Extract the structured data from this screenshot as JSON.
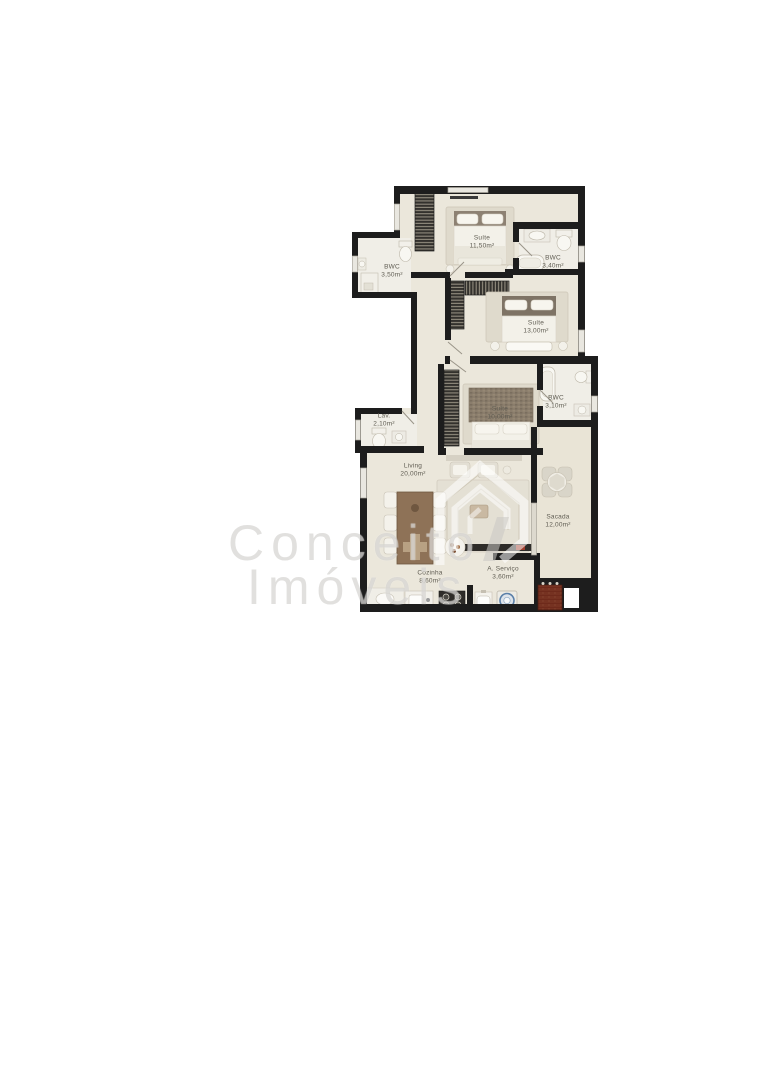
{
  "watermark": {
    "line1": "Conceito",
    "line2": "Imóveis"
  },
  "rooms": {
    "suite_1150": {
      "name": "Suíte",
      "area": "11,50m²"
    },
    "bwc_350": {
      "name": "BWC",
      "area": "3,50m²"
    },
    "bwc_340": {
      "name": "BWC",
      "area": "3,40m²"
    },
    "suite_1300": {
      "name": "Suíte",
      "area": "13,00m²"
    },
    "bwc_310": {
      "name": "BWC",
      "area": "3,10m²"
    },
    "suite_1000": {
      "name": "Suíte",
      "area": "10,00m²"
    },
    "lav": {
      "name": "Lav.",
      "area": "2,10m²"
    },
    "living": {
      "name": "Living",
      "area": "20,00m²"
    },
    "sacada": {
      "name": "Sacada",
      "area": "12,00m²"
    },
    "cozinha": {
      "name": "Cozinha",
      "area": "8,60m²"
    },
    "a_servico": {
      "name": "A. Serviço",
      "area": "3,60m²"
    }
  },
  "furniture_icons": [
    "double-bed",
    "wardrobe",
    "toilet",
    "sink",
    "bathtub",
    "shower",
    "dining-table",
    "chair",
    "lounge-chair",
    "coffee-table",
    "tv-console",
    "round-patio-table",
    "grill",
    "laundry-tank",
    "washing-machine",
    "stove",
    "kitchen-sink"
  ],
  "colors": {
    "background": "#ffffff",
    "wall": "#1d1d1d",
    "floor": "#ebe7db",
    "wet_floor": "#f0eee7",
    "rug": "#dfdacc",
    "wood": "#8e7257",
    "headboard": "#8a7d6c",
    "grill_brick": "#6e2a1b",
    "washer_accent": "#5a7fa8",
    "watermark_gray": "#b8b6b0"
  }
}
